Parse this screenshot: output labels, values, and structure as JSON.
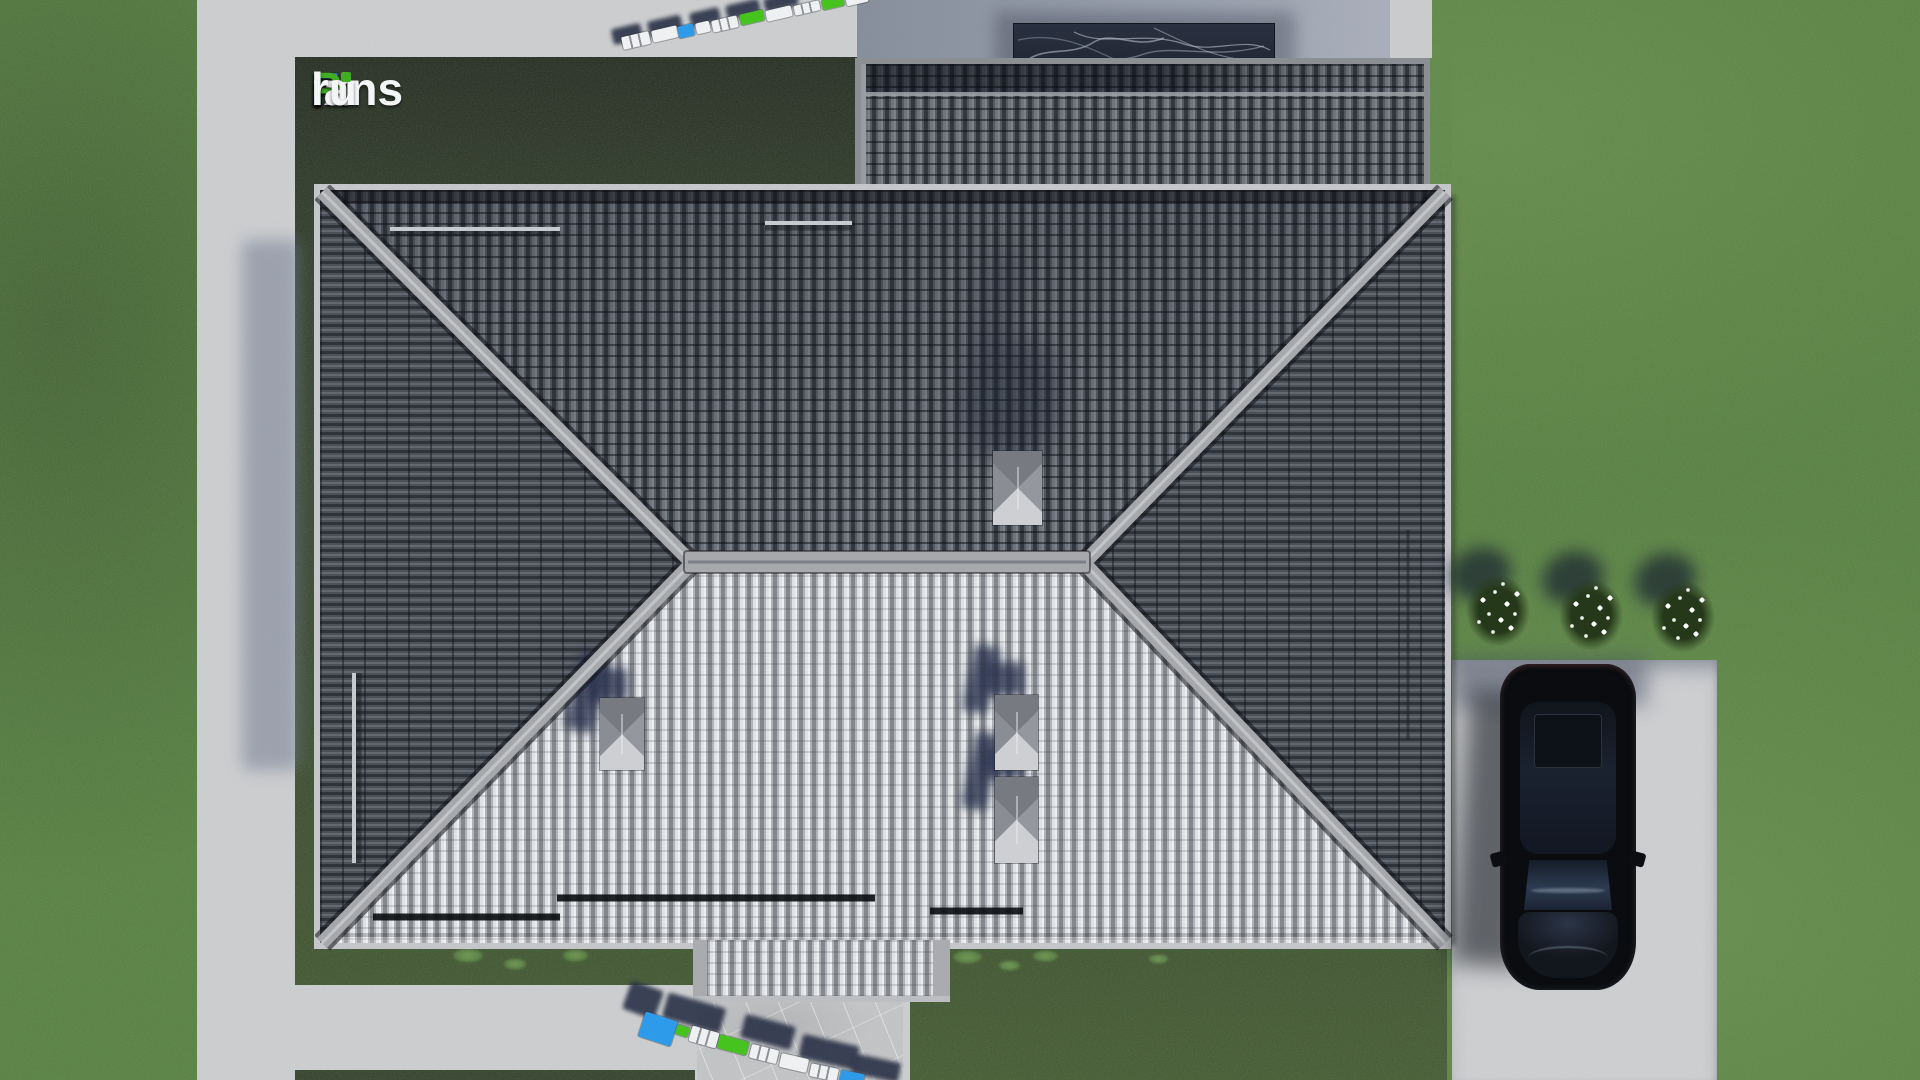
{
  "watermark": {
    "text": "FixPlans.ru",
    "parts": [
      {
        "text": "F",
        "color": "#2f80e8"
      },
      {
        "text": "ix",
        "color": "#f4f5f7"
      },
      {
        "text": "P",
        "color": "#3fae22"
      },
      {
        "text": "lans",
        "color": "#f4f5f7"
      },
      {
        "text": ".",
        "color": "#2f80e8"
      },
      {
        "text": "ru",
        "color": "#f4f5f7"
      }
    ],
    "i_dot_color": "#3fae22"
  },
  "scene": {
    "type": "3d-architectural-render",
    "view": "top-down aerial view of hip-roof house plot",
    "palette": {
      "grass": "#4c7a33",
      "lawn_dark": "#22301b",
      "concrete": "#d1d2d5",
      "patio_shadow": "#8c94a6",
      "roof_dark": "#4a4e56",
      "roof_light": "#b4b6ba",
      "ridge": "#a6a8ac",
      "vent_box": "#94979d",
      "car": "#0a0c0f",
      "ruler_blue": "#2d9bea",
      "ruler_green": "#47c320",
      "ruler_white": "#eef0f2",
      "shadow_navy": "#2b3247"
    }
  }
}
